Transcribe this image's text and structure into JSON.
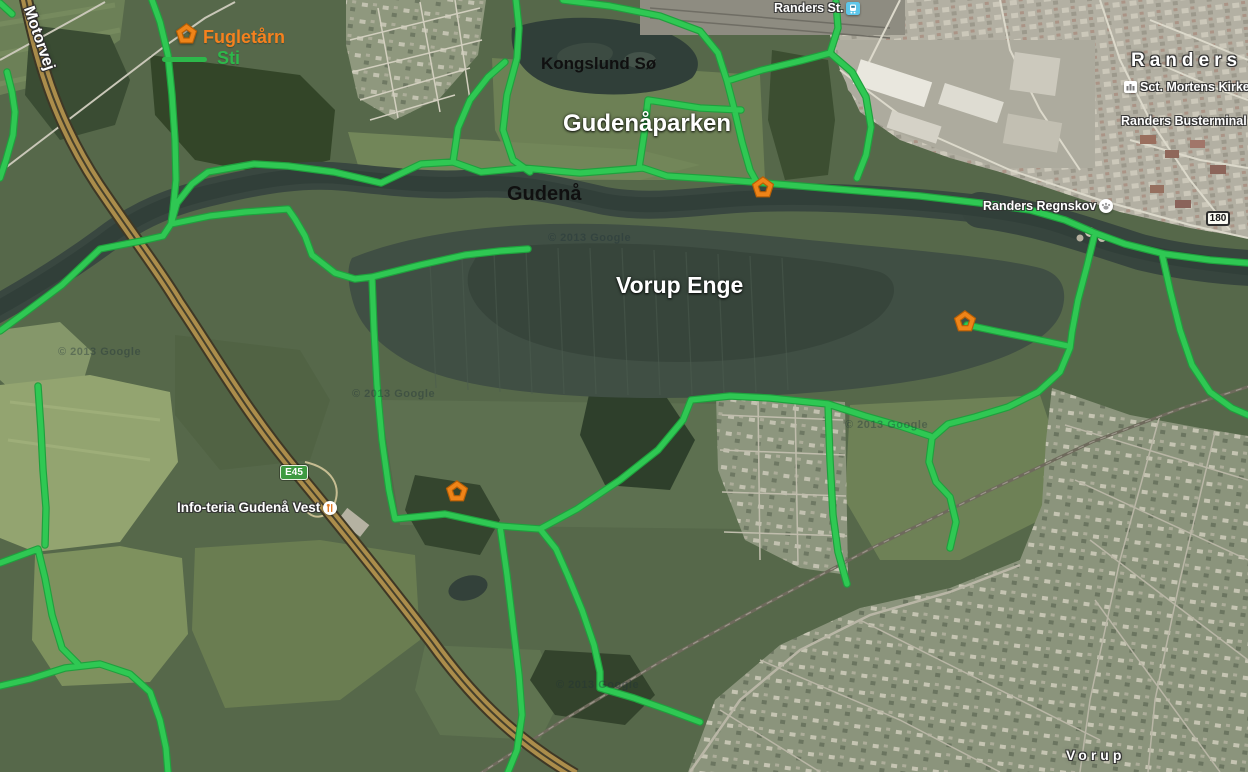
{
  "legend": {
    "fugletaarn_label": "Fugletårn",
    "sti_label": "Sti"
  },
  "place_labels": {
    "motorvej": "Motorvej",
    "kongslund_so": "Kongslund Sø",
    "gudenaaparken": "Gudenåparken",
    "gudenaa": "Gudenå",
    "vorup_enge": "Vorup Enge",
    "randers": "Randers",
    "vorup": "Vorup"
  },
  "pois": {
    "randers_st": "Randers St.",
    "sct_mortens_kirke": "Sct. Mortens Kirke",
    "randers_busterminal": "Randers Busterminal",
    "randers_regnskov": "Randers Regnskov",
    "info_teria": "Info-teria Gudenå Vest"
  },
  "road_shields": {
    "e45": "E45",
    "route_180": "180"
  },
  "watermark": "© 2013 Google",
  "markers": [
    {
      "name": "fugletaarn-tower-gudenaaparken",
      "x": 763,
      "y": 188
    },
    {
      "name": "fugletaarn-tower-vorup-enge-east",
      "x": 965,
      "y": 322
    },
    {
      "name": "fugletaarn-tower-vorup-enge-south",
      "x": 457,
      "y": 492
    }
  ],
  "colors": {
    "trail_green": "#2fc853",
    "marker_orange": "#ef8418",
    "legend_fugletaarn_text": "#f5811e",
    "legend_sti_text": "#2db84b"
  }
}
